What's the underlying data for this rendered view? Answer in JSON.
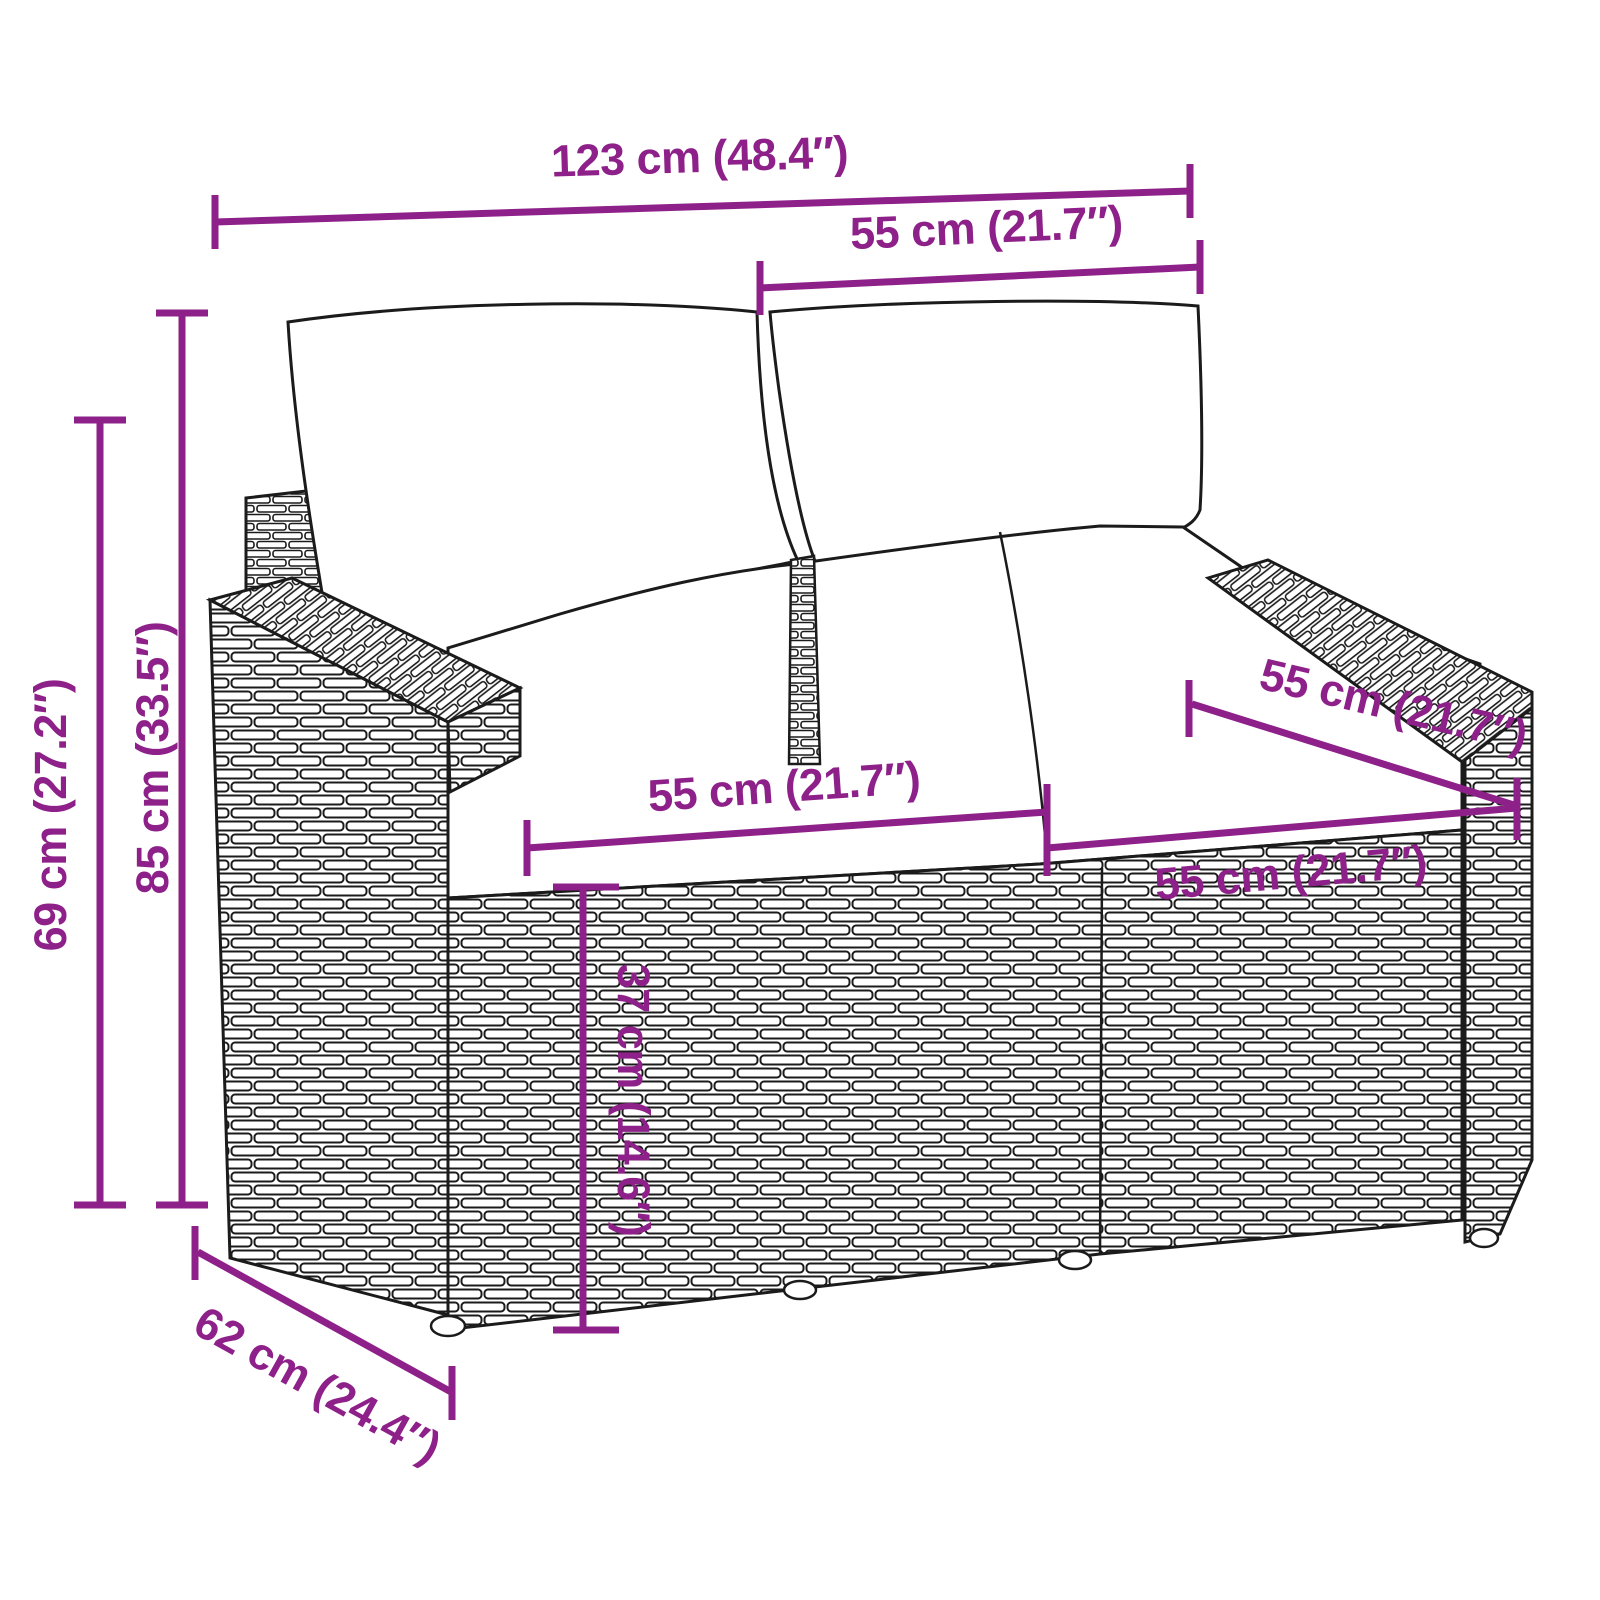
{
  "diagram": {
    "kind": "furniture-dimension-diagram",
    "subject": "poly rattan 2-seater garden sofa with back and seat cushions",
    "background_color": "#FFFFFF",
    "line_art_color": "#1B1B1B",
    "annotation_color": "#8E2089",
    "units": [
      "cm",
      "inch"
    ]
  },
  "dims": {
    "overall_width": {
      "label": "123 cm (48.4″)"
    },
    "backrest_width": {
      "label": "55 cm (21.7″)"
    },
    "overall_height": {
      "label": "85 cm (33.5″)"
    },
    "back_height": {
      "label": "69 cm (27.2″)"
    },
    "seat_height": {
      "label": "37 cm (14.6″)"
    },
    "seat_width_left": {
      "label": "55 cm (21.7″)"
    },
    "seat_width_right": {
      "label": "55 cm (21.7″)"
    },
    "seat_depth": {
      "label": "55 cm (21.7″)"
    },
    "overall_depth": {
      "label": "62 cm (24.4″)"
    }
  }
}
